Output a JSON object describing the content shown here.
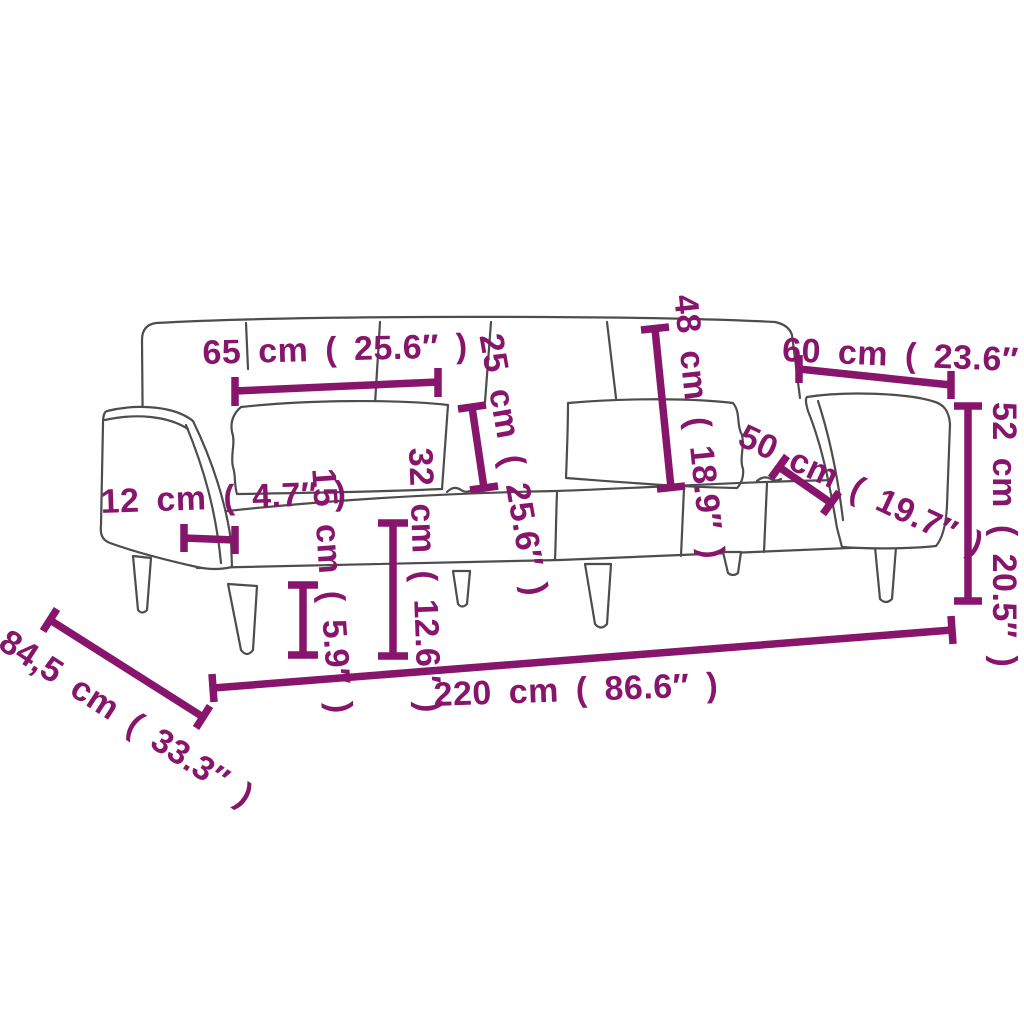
{
  "diagram": {
    "type": "product-dimension-diagram",
    "subject": "sofa-bed"
  },
  "colors": {
    "dimension_annotation": "#87156b",
    "outline": "#4d4d4d",
    "background": "#ffffff"
  },
  "dimensions": {
    "cushion_width": {
      "label": "65 cm ( 25.6″ )",
      "value_cm": "65",
      "value_in": "25.6"
    },
    "pillow_height": {
      "label": "25 cm ( 25.6″ )",
      "value_cm": "25",
      "value_in": "25.6"
    },
    "backrest_height": {
      "label": "48 cm ( 18.9″ )",
      "value_cm": "48",
      "value_in": "18.9"
    },
    "armrest_length": {
      "label": "60 cm ( 23.6″ )",
      "value_cm": "60",
      "value_in": "23.6"
    },
    "seat_depth": {
      "label": "50 cm ( 19.7″ )",
      "value_cm": "50",
      "value_in": "19.7"
    },
    "armrest_height": {
      "label": "52 cm ( 20.5″ )",
      "value_cm": "52",
      "value_in": "20.5"
    },
    "armrest_width": {
      "label": "12 cm ( 4.7″ )",
      "value_cm": "12",
      "value_in": "4.7"
    },
    "leg_height": {
      "label": "15 cm ( 5.9″ )",
      "value_cm": "15",
      "value_in": "5.9"
    },
    "seat_height": {
      "label": "32 cm ( 12.6″ )",
      "value_cm": "32",
      "value_in": "12.6"
    },
    "total_width": {
      "label": "220 cm ( 86.6″ )",
      "value_cm": "220",
      "value_in": "86.6"
    },
    "total_depth": {
      "label": "84,5 cm ( 33.3″ )",
      "value_cm": "84,5",
      "value_in": "33.3"
    }
  }
}
